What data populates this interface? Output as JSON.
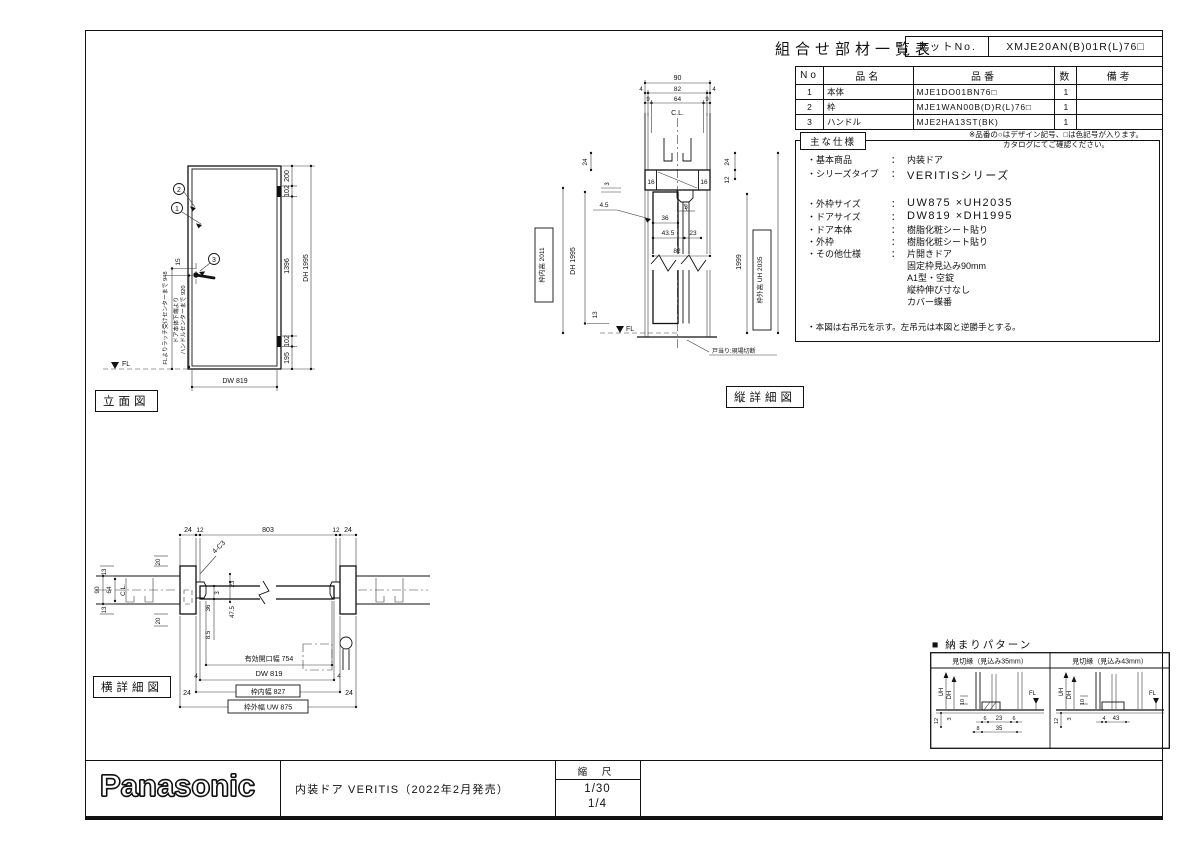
{
  "sheet": {
    "brand": "Panasonic",
    "product_line": "内装ドア VERITIS（2022年2月発売）",
    "scale_label": "縮 尺",
    "scale_1": "1/30",
    "scale_2": "1/4"
  },
  "parts_table": {
    "title": "組合せ部材一覧表",
    "set_no_label": "セットNo.",
    "set_no_value": "XMJE20AN(B)01R(L)76□",
    "col_no": "No",
    "col_name": "品名",
    "col_part": "品番",
    "col_qty": "数",
    "col_remarks": "備考",
    "rows": [
      {
        "no": "1",
        "name": "本体",
        "part": "MJE1DO01BN76□",
        "qty": "1",
        "remarks": ""
      },
      {
        "no": "2",
        "name": "枠",
        "part": "MJE1WAN00B(D)R(L)76□",
        "qty": "1",
        "remarks": ""
      },
      {
        "no": "3",
        "name": "ハンドル",
        "part": "MJE2HA13ST(BK)",
        "qty": "1",
        "remarks": ""
      }
    ],
    "note_1": "※品番の○はデザイン記号、□は色記号が入ります。",
    "note_2": "カタログにてご確認ください。"
  },
  "specs": {
    "title": "主な仕様",
    "rows": [
      {
        "label": "・基本商品",
        "sep": "：",
        "value": "内装ドア"
      },
      {
        "label": "・シリーズタイプ",
        "sep": "：",
        "value": "VERITISシリーズ"
      },
      {
        "label": "・外枠サイズ",
        "sep": "：",
        "value": "UW875 ×UH2035"
      },
      {
        "label": "・ドアサイズ",
        "sep": "：",
        "value": "DW819 ×DH1995"
      },
      {
        "label": "・ドア本体",
        "sep": "：",
        "value": "樹脂化粧シート貼り"
      },
      {
        "label": "・外枠",
        "sep": "：",
        "value": "樹脂化粧シート貼り"
      },
      {
        "label": "・その他仕様",
        "sep": "：",
        "value": "片開きドア"
      },
      {
        "label": "",
        "sep": "",
        "value": "固定枠見込み90mm"
      },
      {
        "label": "",
        "sep": "",
        "value": "A1型・空錠"
      },
      {
        "label": "",
        "sep": "",
        "value": "縦枠伸び寸なし"
      },
      {
        "label": "",
        "sep": "",
        "value": "カバー蝶番"
      }
    ],
    "note": "・本図は右吊元を示す。左吊元は本図と逆勝手とする。"
  },
  "elevation": {
    "label": "立面図",
    "callout_1": "1",
    "callout_2": "2",
    "callout_3": "3",
    "dim_200": "200",
    "dim_102_top": "102",
    "dim_1396": "1396",
    "dim_102_bottom": "102",
    "dim_195": "195",
    "dim_dh": "DH 1995",
    "dim_dw": "DW 819",
    "dim_15": "15",
    "note_latch": "FLよりラッチ受けセンターまで 948",
    "note_handle_1": "ドア本体下端より",
    "note_handle_2": "ハンドルセンターまで 920",
    "fl": "FL"
  },
  "vertical_detail": {
    "label": "縦詳細図",
    "dim_90": "90",
    "dim_4_left": "4",
    "dim_82": "82",
    "dim_4_right": "4",
    "dim_9_left": "9",
    "dim_64": "64",
    "dim_9_right": "9",
    "cl": "C.L.",
    "dim_16_left": "16",
    "dim_16_right": "16",
    "dim_24_left": "24",
    "dim_3_left": "3",
    "dim_24_right": "24",
    "dim_12_right": "12",
    "dim_4_5": "4.5",
    "dim_36": "36",
    "dim_3_stop": "3",
    "dim_43_5": "43.5",
    "dim_23": "23",
    "dim_82_door": "82",
    "box_inner_height": "枠内高 2011",
    "dim_dh": "DH 1995",
    "dim_13": "13",
    "dim_1999": "1999",
    "box_outer_height": "枠外高 UH 2035",
    "fl": "FL",
    "note_doorstop": "戸当り:現場切断"
  },
  "horizontal_detail": {
    "label": "横詳細図",
    "dim_24_l": "24",
    "dim_12_l": "12",
    "dim_803": "803",
    "dim_12_r": "12",
    "dim_24_r": "24",
    "note_c3": "4-C3",
    "dim_13_top": "13",
    "dim_20_top": "20",
    "dim_90": "90",
    "dim_64": "64",
    "cl": "C.L.",
    "dim_13_bottom": "13",
    "dim_20_bottom": "20",
    "dim_23": "23",
    "dim_3": "3",
    "dim_36": "36",
    "dim_47_5": "47.5",
    "dim_8_5": "8.5",
    "dim_opening": "有効開口幅 754",
    "dim_dw": "DW 819",
    "dim_4_l": "4",
    "dim_4_r": "4",
    "dim_24_il": "24",
    "dim_24_ir": "24",
    "box_inner_width": "枠内幅 827",
    "box_outer_width": "枠外幅 UW 875"
  },
  "pattern_section": {
    "title": "■ 納まりパターン",
    "panel_35": {
      "header": "見切縁（見込み35mm）",
      "uh": "UH",
      "dh": "DH",
      "dim_10": "10",
      "dim_12": "12",
      "dim_3": "3",
      "dim_6_l": "6",
      "dim_23": "23",
      "dim_6_r": "6",
      "dim_8": "8",
      "dim_35": "35",
      "fl": "FL"
    },
    "panel_43": {
      "header": "見切縁（見込み43mm）",
      "uh": "UH",
      "dh": "DH",
      "dim_10": "10",
      "dim_12": "12",
      "dim_3": "3",
      "dim_4": "4",
      "dim_43": "43",
      "fl": "FL"
    }
  }
}
